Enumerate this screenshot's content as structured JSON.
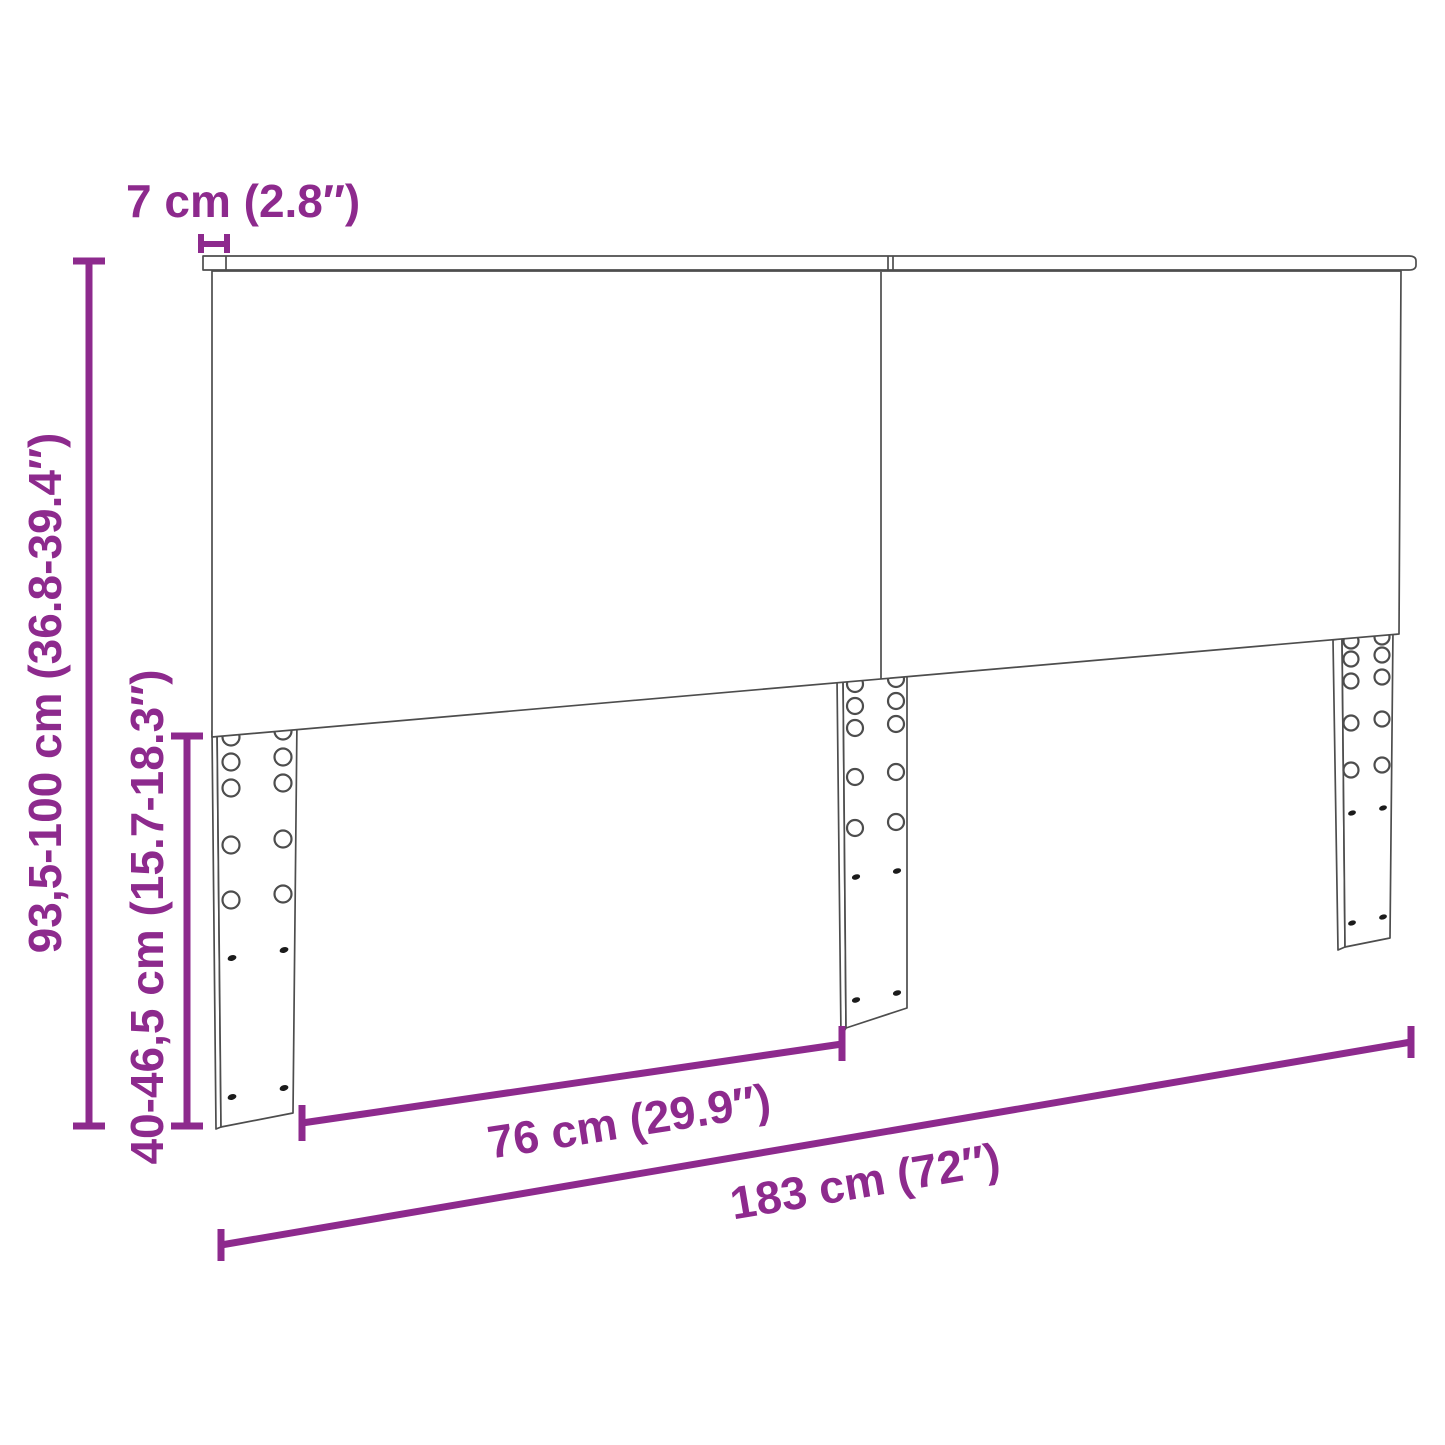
{
  "diagram": {
    "type": "product-dimension-diagram",
    "subject": "headboard with two panels, top rail and three adjustable mounting legs"
  },
  "colors": {
    "dimension_color": "#8D2A8D",
    "outline_color": "#4D4D4D",
    "background": "#FFFFFF"
  },
  "dimensions": {
    "thickness": {
      "label": "7 cm (2.8″)",
      "cm": "7",
      "inches": "2.8"
    },
    "total_height": {
      "label": "93,5-100 cm (36.8-39.4″)",
      "cm": "93,5-100",
      "inches": "36.8-39.4"
    },
    "leg_height": {
      "label": "40-46,5 cm (15.7-18.3″)",
      "cm": "40-46,5",
      "inches": "15.7-18.3"
    },
    "leg_spacing": {
      "label": "76 cm (29.9″)",
      "cm": "76",
      "inches": "29.9"
    },
    "total_width": {
      "label": "183 cm (72″)",
      "cm": "183",
      "inches": "72"
    }
  }
}
